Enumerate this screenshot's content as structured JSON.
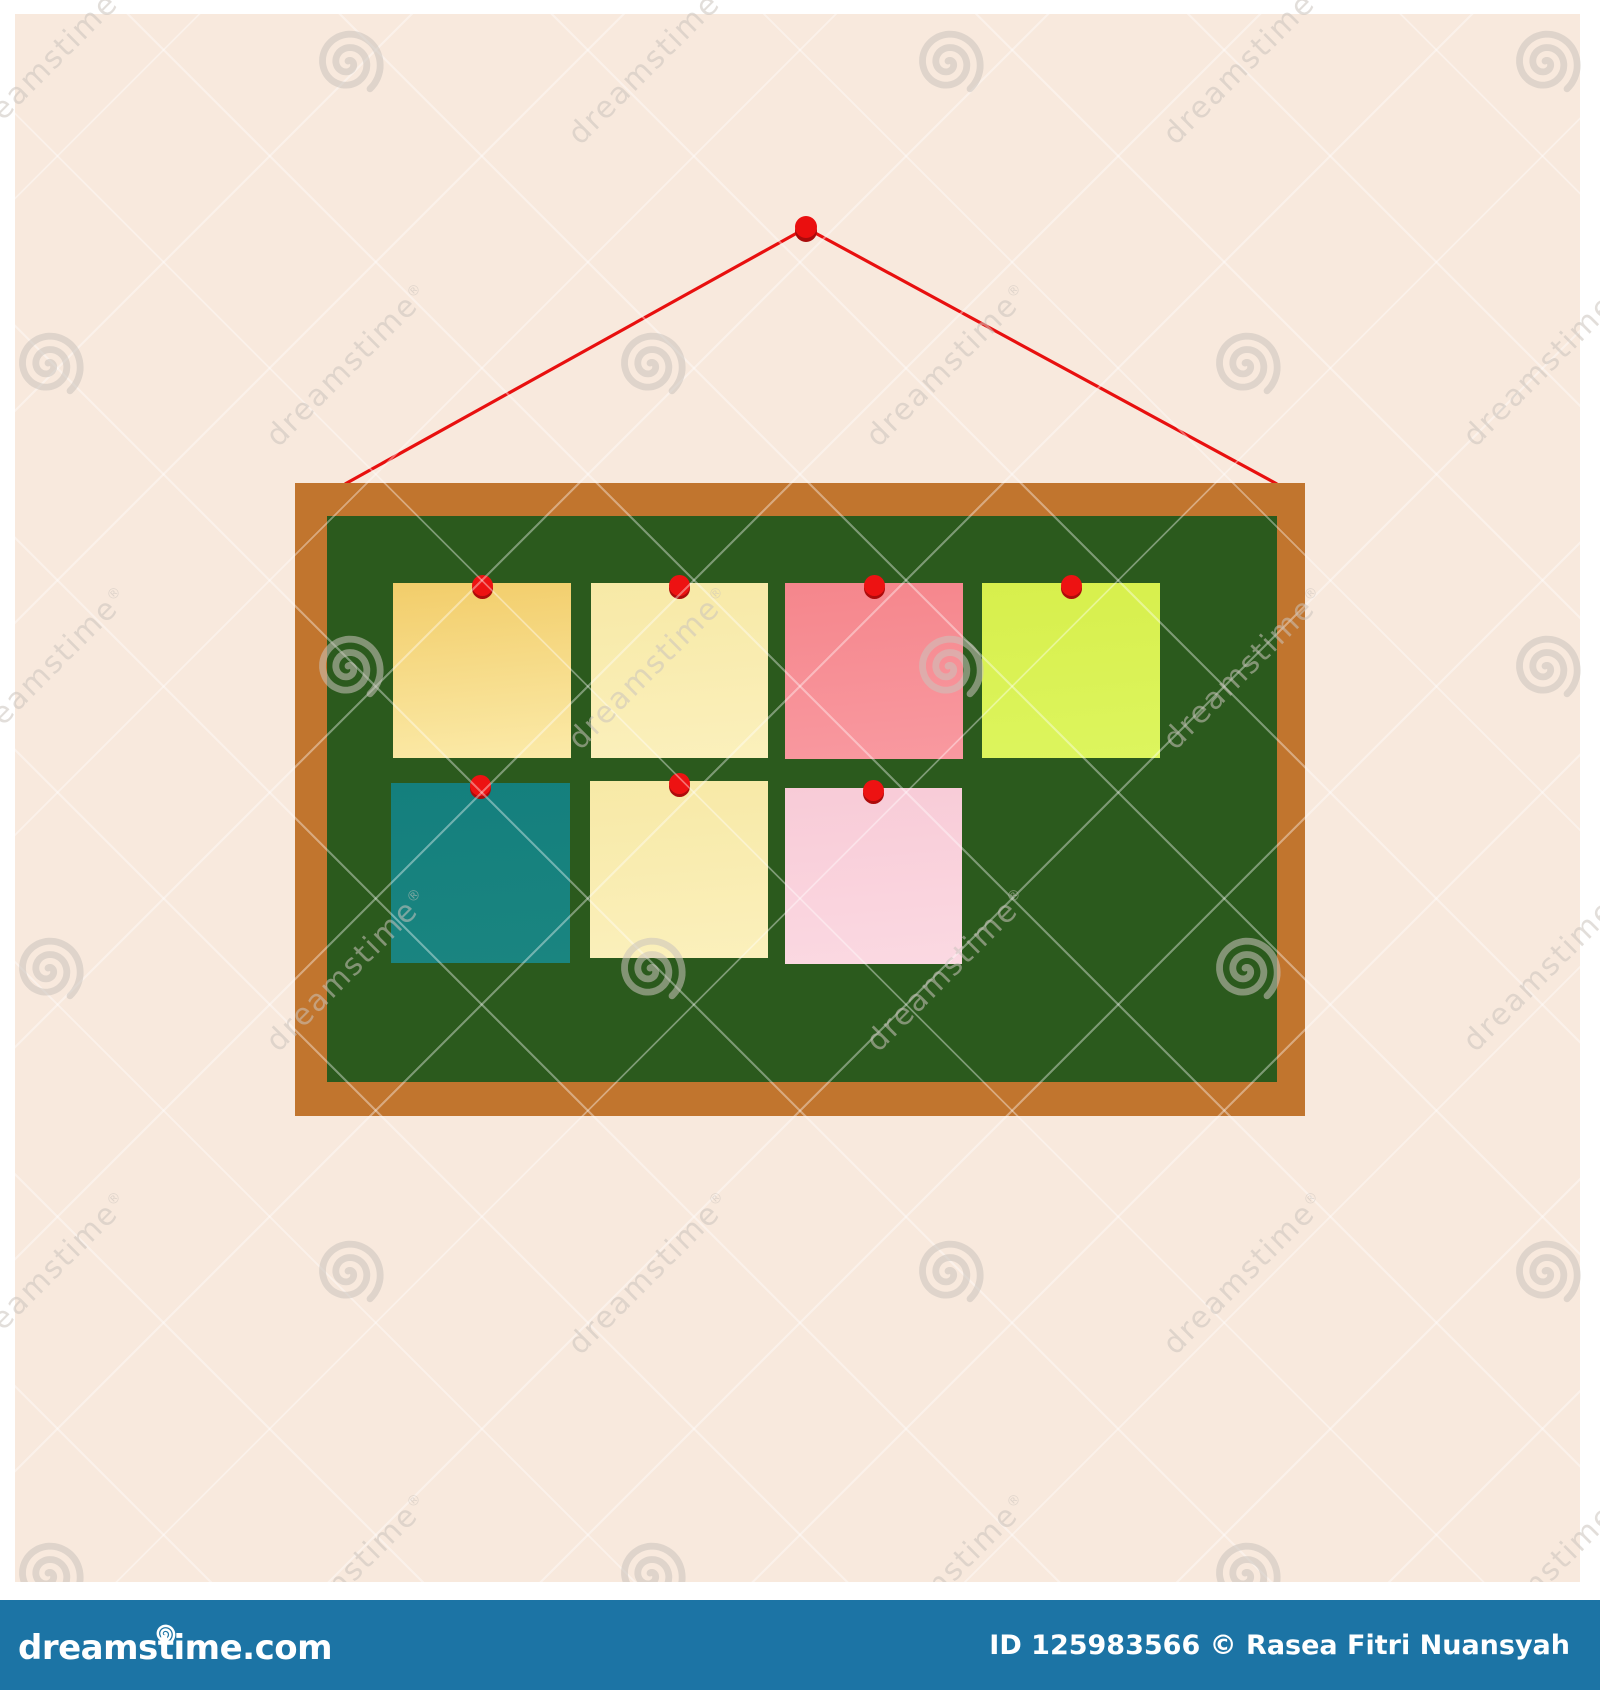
{
  "wall": {
    "color": "#f8e9dd"
  },
  "hanging": {
    "string_color": "#e8100f",
    "pin_color": "#ea0f0f",
    "pin_shadow_color": "#a90b0b"
  },
  "board": {
    "frame_color": "#c1752e",
    "surface_color": "#2b5a1d",
    "note_pin_color": "#ed1212",
    "note_pin_shadow_color": "#ad0b0b",
    "notes": [
      {
        "name": "gold-note",
        "color_top": "#f2cd6a",
        "color_bottom": "#fbeaa8"
      },
      {
        "name": "cream-note",
        "color_top": "#f7e9a6",
        "color_bottom": "#fbf0bc"
      },
      {
        "name": "salmon-note",
        "color_top": "#f5868c",
        "color_bottom": "#f999a0"
      },
      {
        "name": "lime-note",
        "color_top": "#d7ef4c",
        "color_bottom": "#ddf55e"
      },
      {
        "name": "teal-note",
        "color_top": "#147f7d",
        "color_bottom": "#1a8580"
      },
      {
        "name": "cream-note-2",
        "color_top": "#f7e9a6",
        "color_bottom": "#fbf0bc"
      },
      {
        "name": "pink-note",
        "color_top": "#f8cbd7",
        "color_bottom": "#fbd9e2"
      }
    ]
  },
  "watermark": {
    "text": "dreamstime",
    "registered_mark": "®",
    "tile_color": "#cbc4bd"
  },
  "footer": {
    "logo_text": "dreamstime.com",
    "credit_text": "ID 125983566 © Rasea Fitri Nuansyah",
    "bar_color": "#1c74a5",
    "text_color": "#ffffff"
  }
}
